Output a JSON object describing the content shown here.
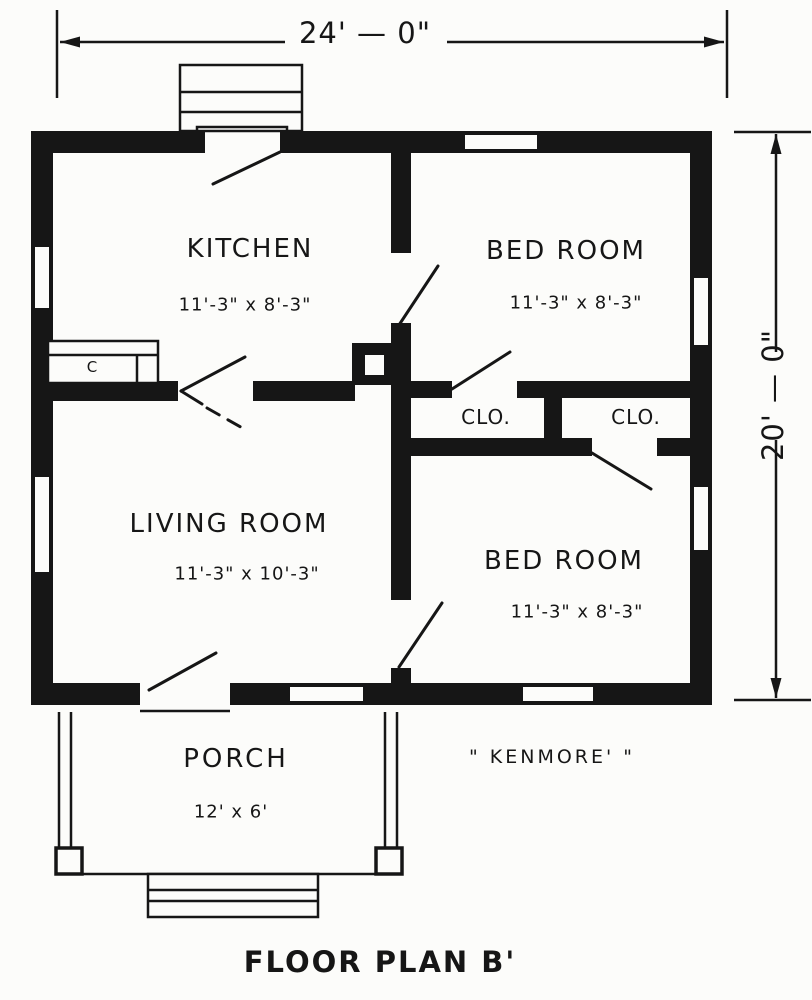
{
  "plan": {
    "title": "FLOOR PLAN B'",
    "house_name": "\" KENMORE' \"",
    "dimensions": {
      "overall_width": "24' — 0\"",
      "overall_depth": "20' — 0\""
    },
    "rooms": [
      {
        "name": "KITCHEN",
        "size": "11'-3\" x 8'-3\""
      },
      {
        "name": "BED ROOM",
        "size": "11'-3\" x 8'-3\""
      },
      {
        "name": "LIVING ROOM",
        "size": "11'-3\" x 10'-3\""
      },
      {
        "name": "BED ROOM",
        "size": "11'-3\" x 8'-3\""
      },
      {
        "name": "PORCH",
        "size": "12' x 6'"
      },
      {
        "name": "CLO.",
        "size": ""
      },
      {
        "name": "CLO.",
        "size": ""
      }
    ],
    "annotations": {
      "counter": "C"
    }
  }
}
